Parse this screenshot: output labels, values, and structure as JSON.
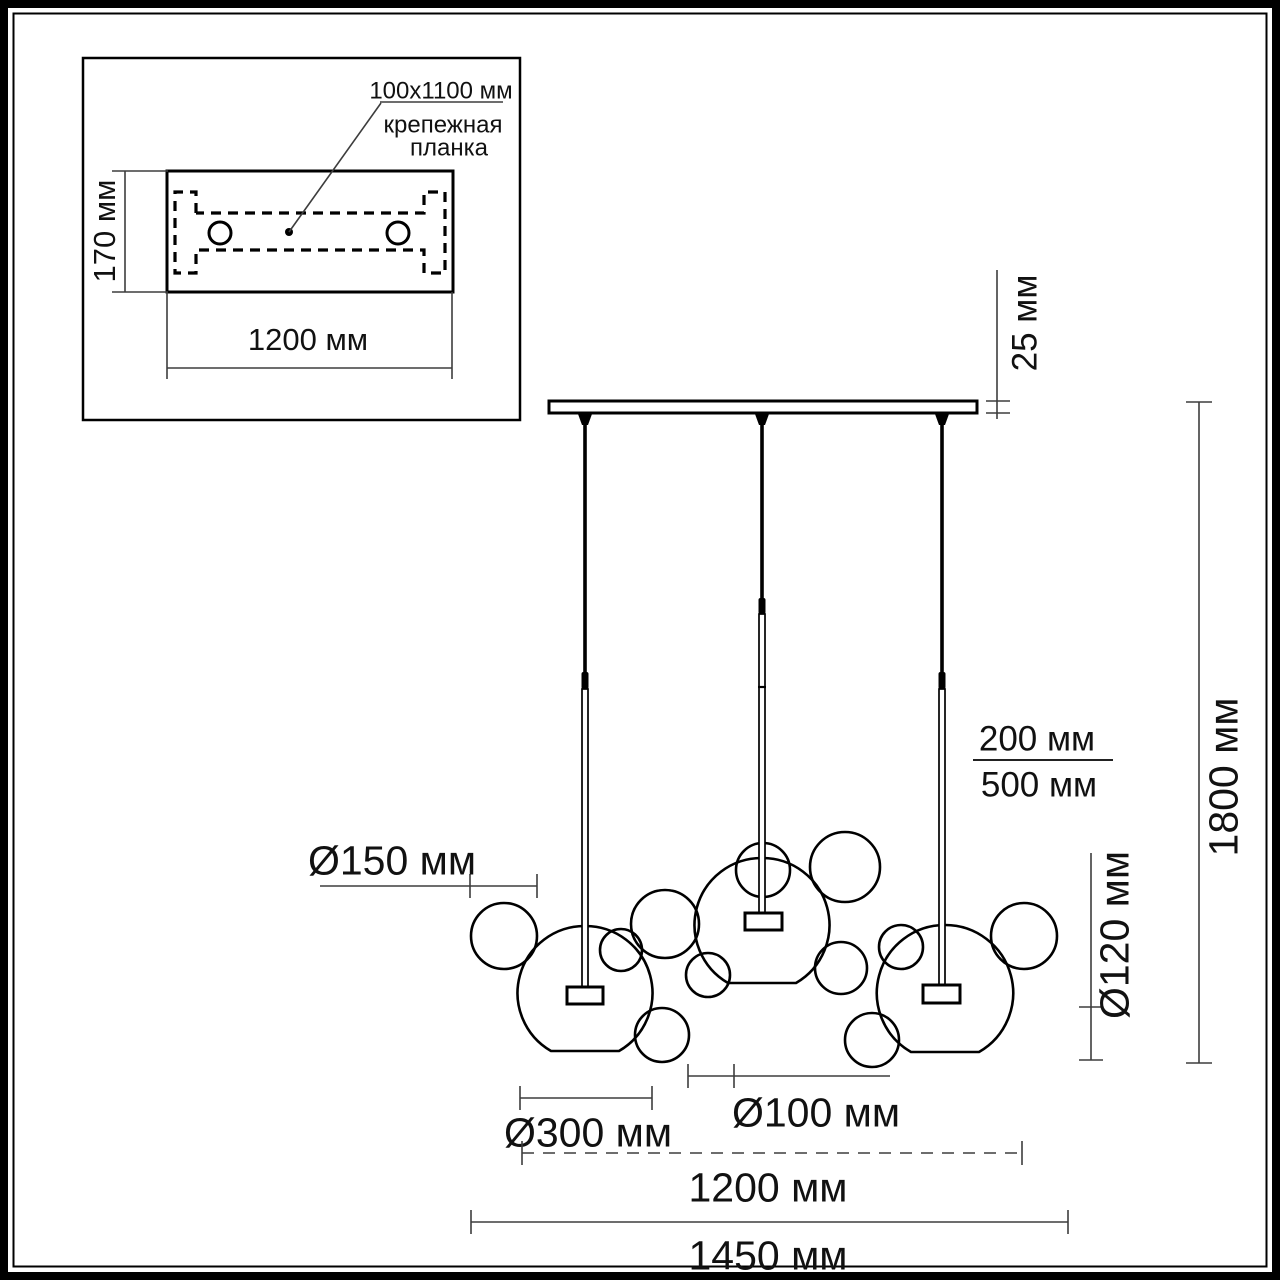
{
  "diagram": {
    "inset": {
      "plate_height_label": "170 мм",
      "plate_width_label": "1200 мм",
      "callout": {
        "line1": "100x1100 мм",
        "line2": "крепежная",
        "line3": "планка"
      }
    },
    "dimensions": {
      "canopy_thickness": "25 мм",
      "total_height": "1800 мм",
      "cord_length_top": "200 мм",
      "cord_length_bottom": "500 мм",
      "bubble_d150": "Ø150 мм",
      "bubble_d120": "Ø120 мм",
      "bubble_d300": "Ø300 мм",
      "bubble_d100": "Ø100 мм",
      "inner_span": "1200 мм",
      "outer_span": "1450 мм"
    },
    "colors": {
      "line": "#000000",
      "dimension_line": "#3d3d3d",
      "background": "#ffffff"
    }
  }
}
